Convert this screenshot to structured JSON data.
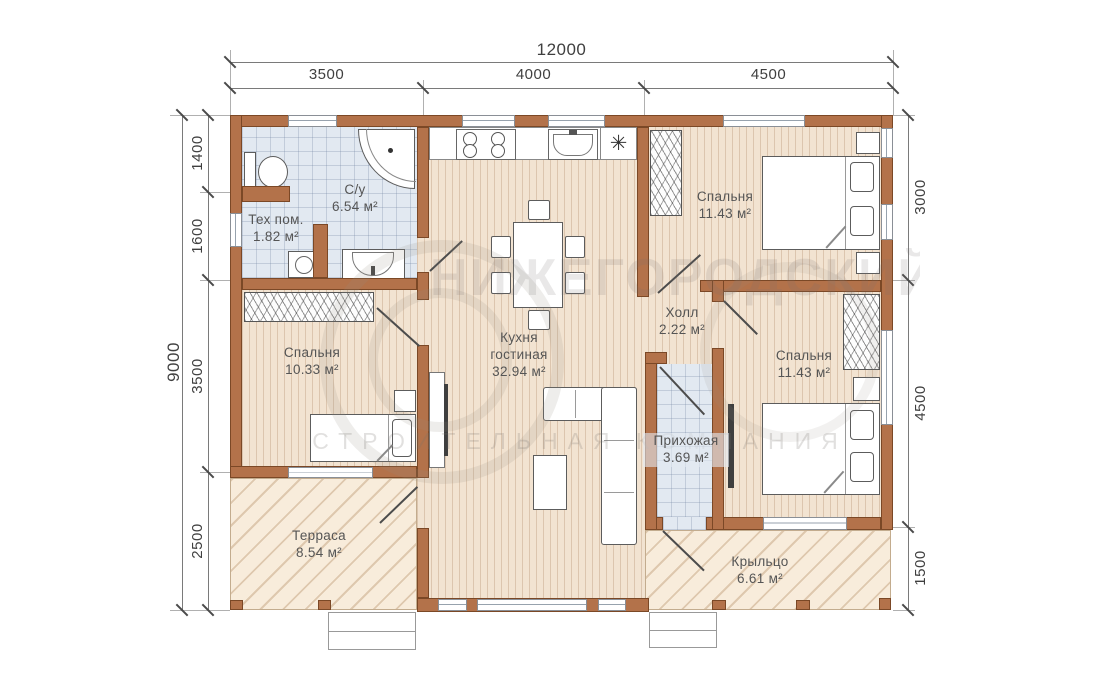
{
  "dims": {
    "top_total": "12000",
    "top_segments": [
      "3500",
      "4000",
      "4500"
    ],
    "left_total": "9000",
    "left_segments": [
      "1400",
      "1600",
      "3500",
      "2500"
    ],
    "right_segments": [
      "3000",
      "4500",
      "1500"
    ]
  },
  "rooms": {
    "su": {
      "name": "С/у",
      "area": "6.54 м²"
    },
    "teh": {
      "name": "Тех пом.",
      "area": "1.82 м²"
    },
    "bedroom_top": {
      "name": "Спальня",
      "area": "11.43 м²"
    },
    "bedroom_left": {
      "name": "Спальня",
      "area": "10.33 м²"
    },
    "kitchen": {
      "name": "Кухня",
      "name2": "гостиная",
      "area": "32.94 м²"
    },
    "hall": {
      "name": "Холл",
      "area": "2.22 м²"
    },
    "hallway": {
      "name": "Прихожая",
      "area": "3.69 м²"
    },
    "bedroom_right": {
      "name": "Спальня",
      "area": "11.43 м²"
    },
    "terrace": {
      "name": "Терраса",
      "area": "8.54 м²"
    },
    "porch": {
      "name": "Крыльцо",
      "area": "6.61 м²"
    }
  },
  "icons": {
    "fridge": "✳"
  },
  "watermark": {
    "line1": "НИЖЕГОРОДСКИЙ",
    "line2": "СТРОИТЕЛЬНАЯ КОМПАНИЯ"
  },
  "colors": {
    "wall": "#b3724a",
    "wall_border": "#7b4826",
    "wood": "#f2e3d1",
    "tile": "#e2e9f1",
    "hatch": "#f8ecdb"
  }
}
